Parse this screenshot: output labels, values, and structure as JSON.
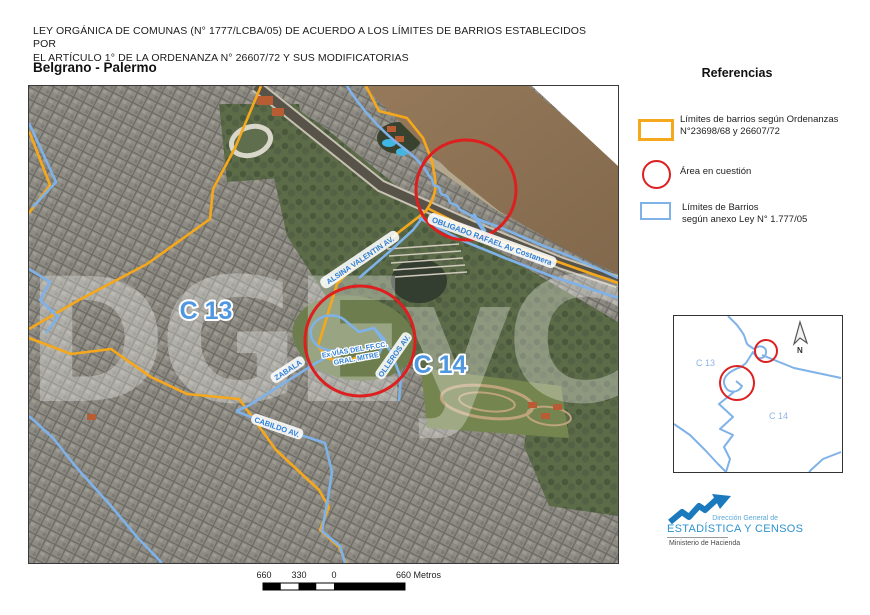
{
  "header": {
    "title_line1": "LEY ORGÁNICA DE COMUNAS (N° 1777/LCBA/05) DE ACUERDO A LOS LÍMITES DE BARRIOS ESTABLECIDOS POR",
    "title_line2": "EL ARTÍCULO 1° DE LA ORDENANZA N° 26607/72 Y SUS MODIFICATORIAS",
    "subtitle": "Belgrano - Palermo"
  },
  "legend": {
    "title": "Referencias",
    "items": [
      {
        "swatch": "orange-rectangle",
        "line1": "Límites de barrios según Ordenanzas",
        "line2": "N°23698/68 y 26607/72"
      },
      {
        "swatch": "red-circle",
        "line1": "Área en cuestión",
        "line2": ""
      },
      {
        "swatch": "blue-rectangle",
        "line1": "Límites de Barrios",
        "line2": "según anexo Ley N° 1.777/05"
      }
    ]
  },
  "map": {
    "watermark": "DGEyC",
    "region_labels": {
      "c13": "C 13",
      "c14": "C 14"
    },
    "street_labels": {
      "alsina": "ALSINA VALENTIN AV.",
      "obligado": "OBLIGADO RAFAEL Av Costanera",
      "exvias_line1": "Ex VÍAS DEL FF.CC.",
      "exvias_line2": "GRAL. MITRE",
      "olleros": "OLLEROS AV.",
      "zabala": "ZABALA",
      "cabildo": "CABILDO AV."
    }
  },
  "inset": {
    "c13": "C 13",
    "c14": "C 14",
    "north": "N"
  },
  "scalebar": {
    "left": "660",
    "mid": "330",
    "zero": "0",
    "right": "660 Metros"
  },
  "logo": {
    "line1": "Dirección General de",
    "line2": "ESTADÍSTICA Y CENSOS",
    "line3": "Ministerio de Hacienda"
  },
  "colors": {
    "ordenanzas_orange": "#F6A81C",
    "ley_blue": "#7FB2E8",
    "area_red": "#DD1F1F"
  }
}
